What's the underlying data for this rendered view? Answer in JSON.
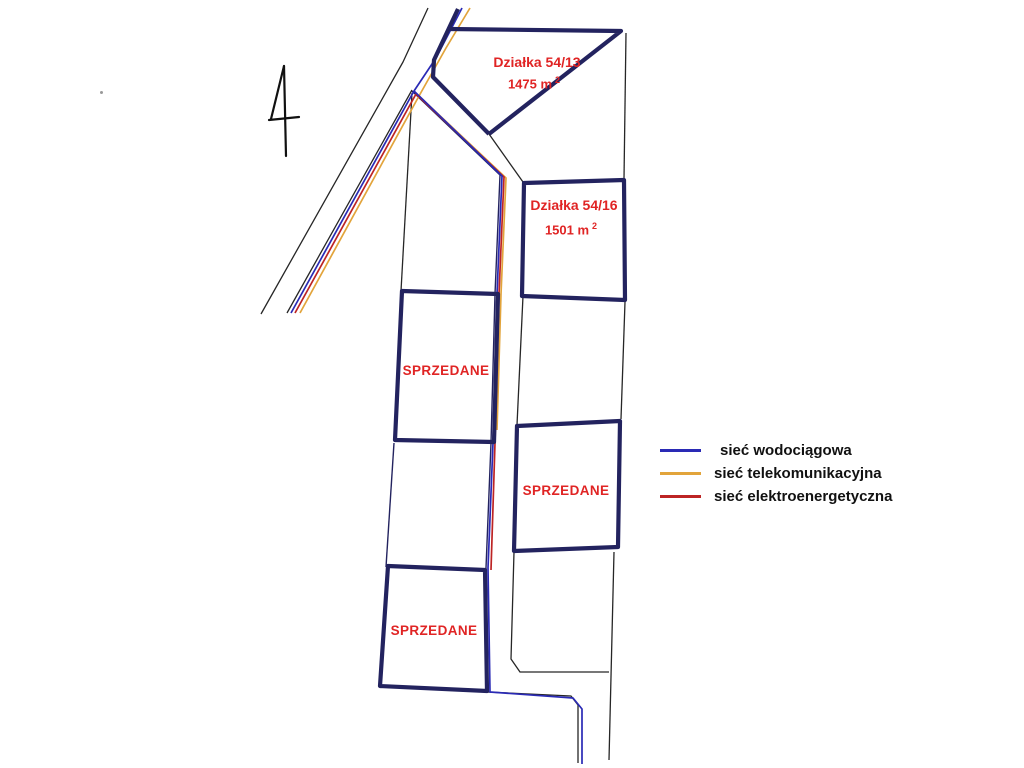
{
  "map": {
    "plots": [
      {
        "name": "Działka 54/13",
        "area": "1475 m",
        "area_sup": "2"
      },
      {
        "name": "Działka 54/16",
        "area": "1501 m",
        "area_sup": "2"
      }
    ],
    "sold_label": "SPRZEDANE"
  },
  "legend": {
    "items": [
      {
        "id": "water",
        "label": "sieć wodociągowa",
        "color": "#2a2ab5"
      },
      {
        "id": "telecom",
        "label": "sieć telekomunikacyjna",
        "color": "#e2a43b"
      },
      {
        "id": "power",
        "label": "sieć elektroenergetyczna",
        "color": "#bd2424"
      }
    ]
  },
  "colors": {
    "parcel_border": "#23235f",
    "boundary_line": "#262626",
    "water": "#2a2ab5",
    "telecom": "#e2a43b",
    "power": "#bd2424",
    "label_red": "#e02424",
    "legend_text": "#111111"
  }
}
